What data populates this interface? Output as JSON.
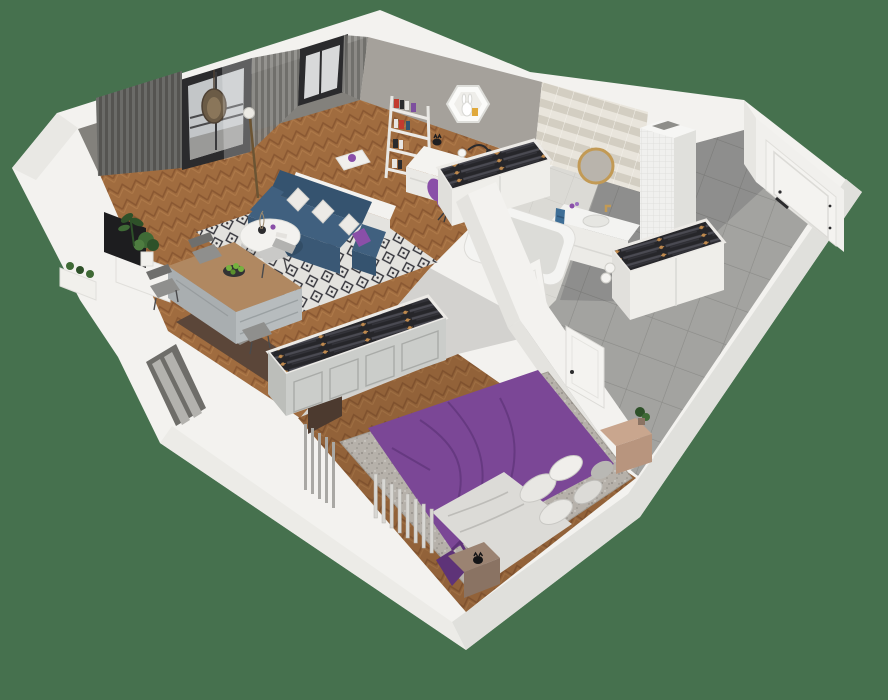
{
  "scene": {
    "type": "isometric-3d-floor-plan",
    "label": "3D floor plan of a one-bedroom apartment",
    "rooms": [
      {
        "name": "living-room",
        "objects": [
          "gray-curtains",
          "balcony-door",
          "hanging-egg-chair",
          "window",
          "blue-sofa",
          "throw-pillows",
          "diamond-pattern-rug",
          "round-coffee-table",
          "tv",
          "tv-stand",
          "floor-lamp",
          "potted-plants",
          "herringbone-wood-floor"
        ]
      },
      {
        "name": "study-nook",
        "objects": [
          "gray-feature-wall",
          "hexagon-wall-shelf",
          "ladder-bookshelf",
          "white-desk",
          "desk-lamp",
          "purple-chair",
          "cat-figurine"
        ]
      },
      {
        "name": "kitchen-dining",
        "objects": [
          "wood-top-island",
          "gray-cabinets",
          "bar-chairs",
          "fruit-bowl-with-apples",
          "dark-countertop",
          "cooktop",
          "faucet",
          "kitchen-window-radiator"
        ]
      },
      {
        "name": "walk-in-closet",
        "objects": [
          "open-wardrobe",
          "hanging-dark-clothes",
          "gold-hangers",
          "paneled-doors"
        ]
      },
      {
        "name": "bathroom",
        "objects": [
          "herringbone-tile-wall",
          "round-gold-mirror",
          "vanity-with-sink",
          "blue-towel",
          "bathtub",
          "white-tiled-column",
          "bathroom-door"
        ]
      },
      {
        "name": "hallway",
        "objects": [
          "gray-tile-floor",
          "open-wardrobe-clothes",
          "entry-door-with-black-handle",
          "white-walls"
        ]
      },
      {
        "name": "bedroom",
        "objects": [
          "purple-double-bed",
          "white-gray-pillows",
          "white-blanket",
          "gray-area-rug",
          "wood-nightstands",
          "plant",
          "black-cat-figure",
          "radiators",
          "bedroom-door",
          "herringbone-wood-floor"
        ]
      }
    ]
  },
  "colors": {
    "background": "#46714e",
    "wall_outer": "#f3f2ef",
    "wall_face_shade": "#e0e0dc",
    "wall_face_light": "#ecebe7",
    "wall_inner": "#f3f2ef",
    "wall_inner_shade": "#e4e3df",
    "gray_wall": "#a5a19b",
    "gray_wall_dark": "#83817c",
    "wood_base": "#a06c3f",
    "wood_dark": "#8a5832",
    "wood_light": "#b5814f",
    "corridor_floor": "#d3d2cf",
    "rug_base": "#e3e2de",
    "rug_diamond": "#33333a",
    "sofa": "#40607f",
    "sofa_dark": "#35536f",
    "sofa_front": "#3a5875",
    "pillow_white": "#eceae6",
    "pillow_purple": "#8a4fa8",
    "curtain_a": "#6e6d69",
    "curtain_b": "#8d8c88",
    "frame_dark": "#2b2b2d",
    "glass": "#c3c6c8",
    "bed": "#7b4796",
    "bed_dark": "#5e3378",
    "blanket": "#dcdbd7",
    "bed_rug": "#b6b1aa",
    "nightstand": "#c9a68e",
    "nightstand_dark": "#9b8372",
    "radiator": "#d8d7d3",
    "radiator_dark": "#a9a8a4",
    "closet_front": "#cbcdca",
    "closet_panel": "#a9aba8",
    "clothes_dark": "#26262a",
    "hanger_gold": "#c08a4e",
    "tile_floor": "#dbdad5",
    "tile_wall_a": "#e9e5dc",
    "tile_wall_b": "#d3cec2",
    "tub": "#f4f4f2",
    "tub_inner": "#dcdcd8",
    "vanity": "#f3f3f1",
    "mirror_gold": "#c29a55",
    "mirror_glass": "#b9b4ac",
    "towel": "#3e6e96",
    "hall_tile": "#a3a3a0",
    "hall_grout": "#8b8b88",
    "door": "#f4f3f0",
    "handle": "#2b2b2d",
    "counter_top": "#5b4639",
    "cabinet": "#b7bcbe",
    "hob": "#17171a",
    "island_wood": "#b08861",
    "apple": "#76b13f",
    "chair": "#8f8f8d",
    "plant": "#3f6a36",
    "plant_dark": "#2e5129",
    "tv": "#1d1d1f",
    "lamp_metal": "#6b5433"
  }
}
